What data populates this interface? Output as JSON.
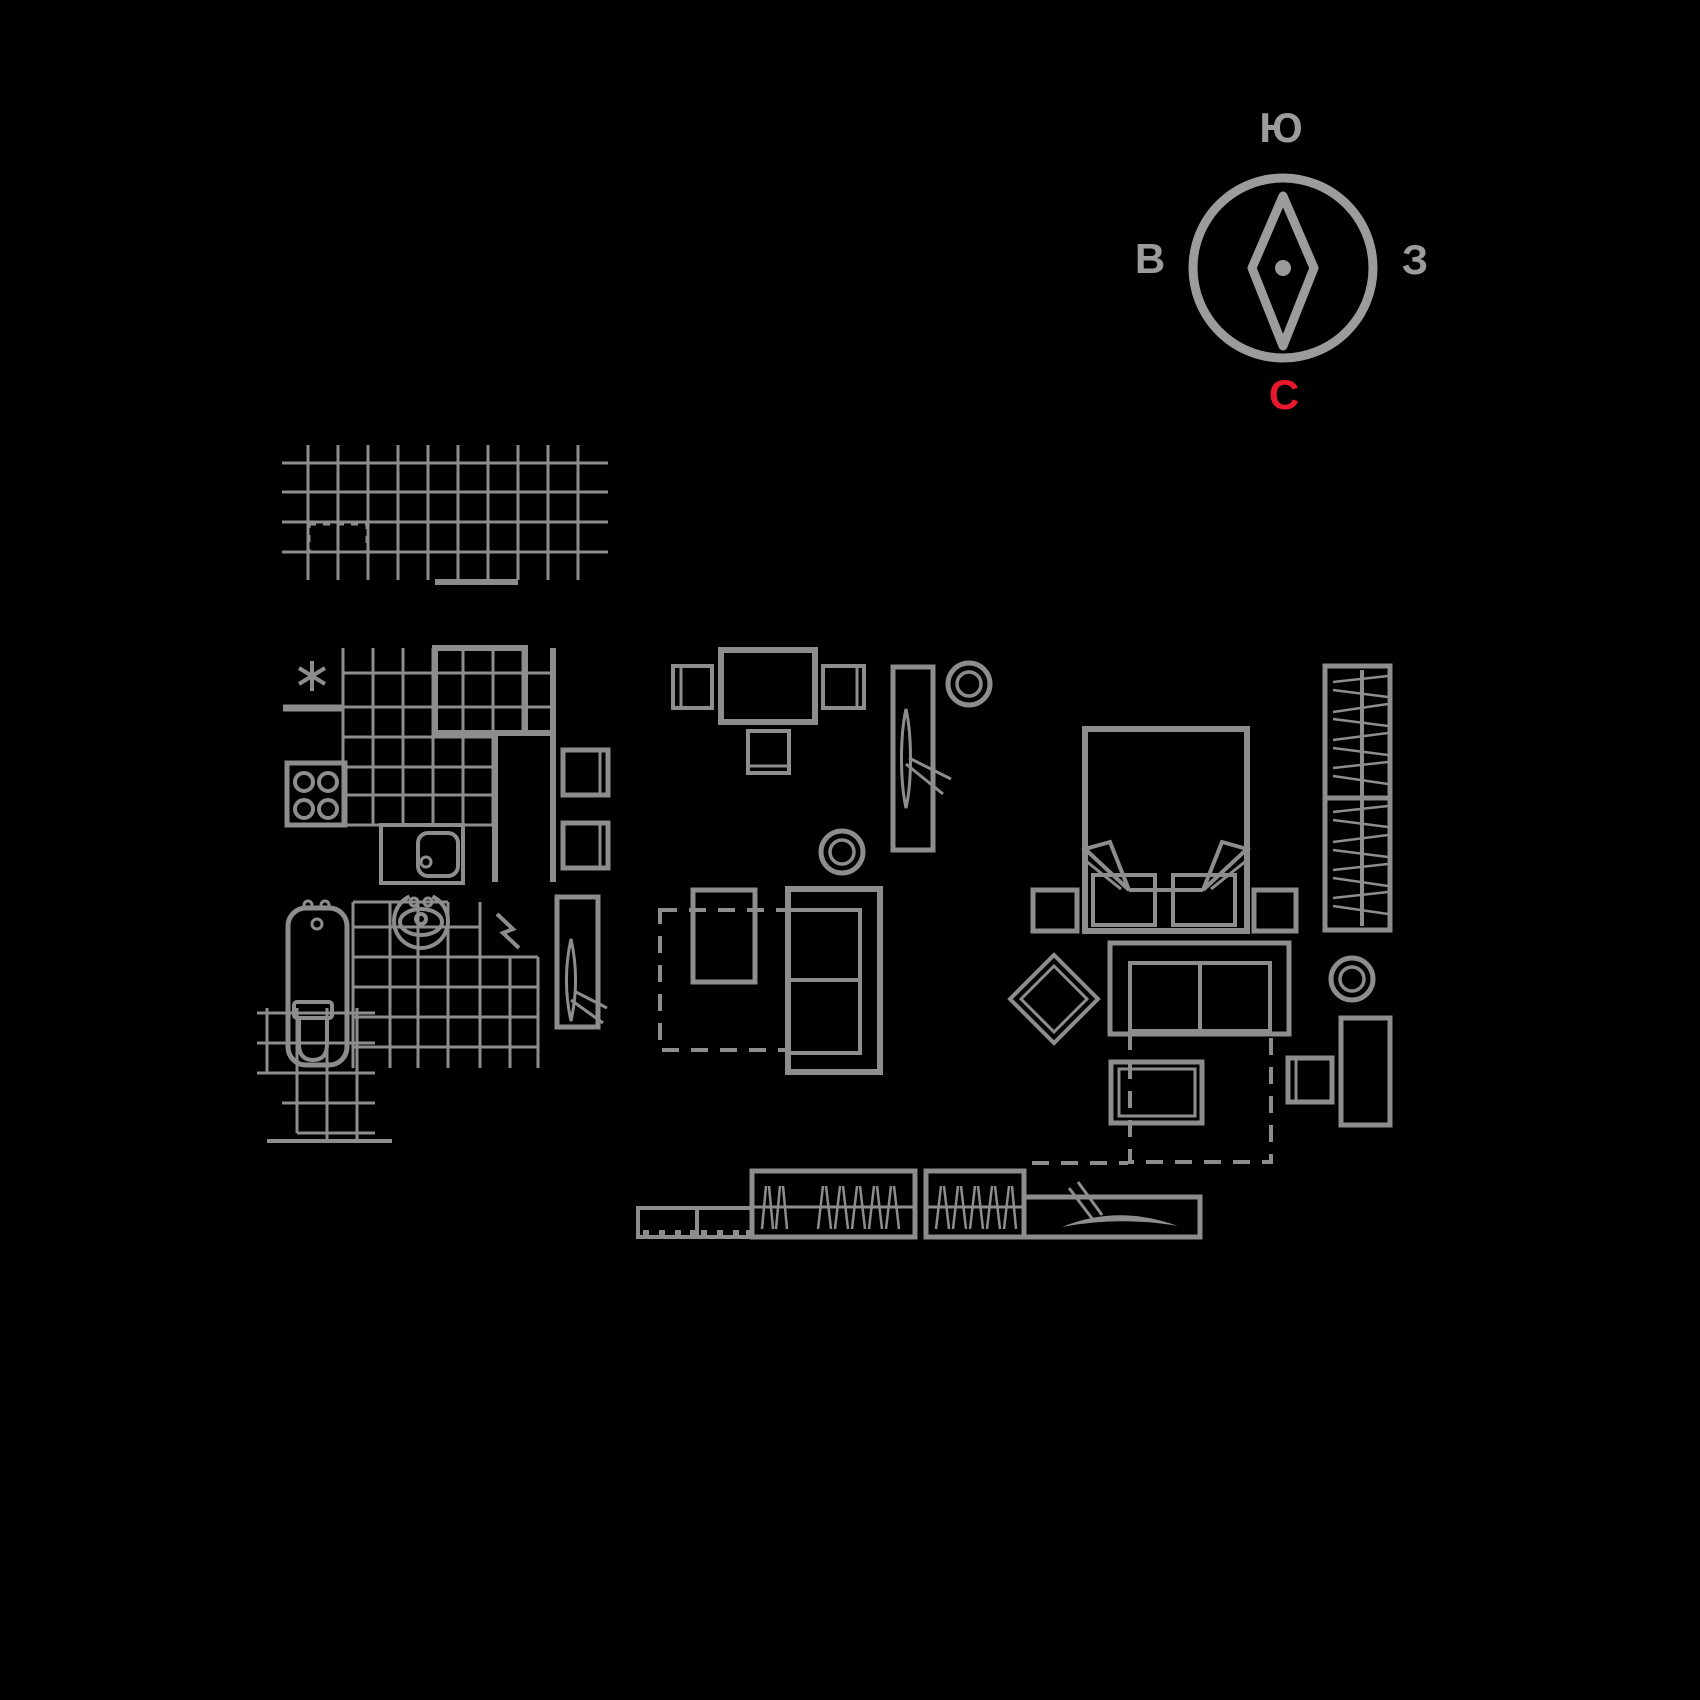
{
  "colors": {
    "background": "#000000",
    "plan_line": "#8d8d8d",
    "compass": "#9c9c9c",
    "north_red": "#e8192d"
  },
  "compass": {
    "top": "Ю",
    "left": "В",
    "right": "З",
    "bottom": "С"
  },
  "plan_items": [
    "compass-rose",
    "balcony-tile-grid",
    "kitchen-note-asterisk",
    "kitchen-tile-grid",
    "kitchen-window-shaft",
    "stove-four-burners",
    "kitchen-sink-counter",
    "kitchen-appliance-cabinets",
    "bathtub",
    "washbasin",
    "electric-water-heater-symbol",
    "bathroom-tile-grid",
    "bathroom-door",
    "toilet",
    "toilet-tile-grid",
    "dining-table",
    "dining-chair-left",
    "dining-chair-right",
    "dining-chair-bottom",
    "room-door",
    "ceiling-lamp",
    "floor-lamp",
    "living-rug-dashed",
    "side-table",
    "sofa",
    "double-bed",
    "pillow-left",
    "pillow-right",
    "nightstand-left",
    "nightstand-right",
    "ottoman-diamond",
    "dresser",
    "bedroom-rug-dashed",
    "bench",
    "wardrobe-with-hangers",
    "lamp-ring",
    "tall-cabinet",
    "small-cabinet",
    "tv-stand-with-feet",
    "closet-hatched-left",
    "closet-hatched-right",
    "sliding-door-unit"
  ]
}
